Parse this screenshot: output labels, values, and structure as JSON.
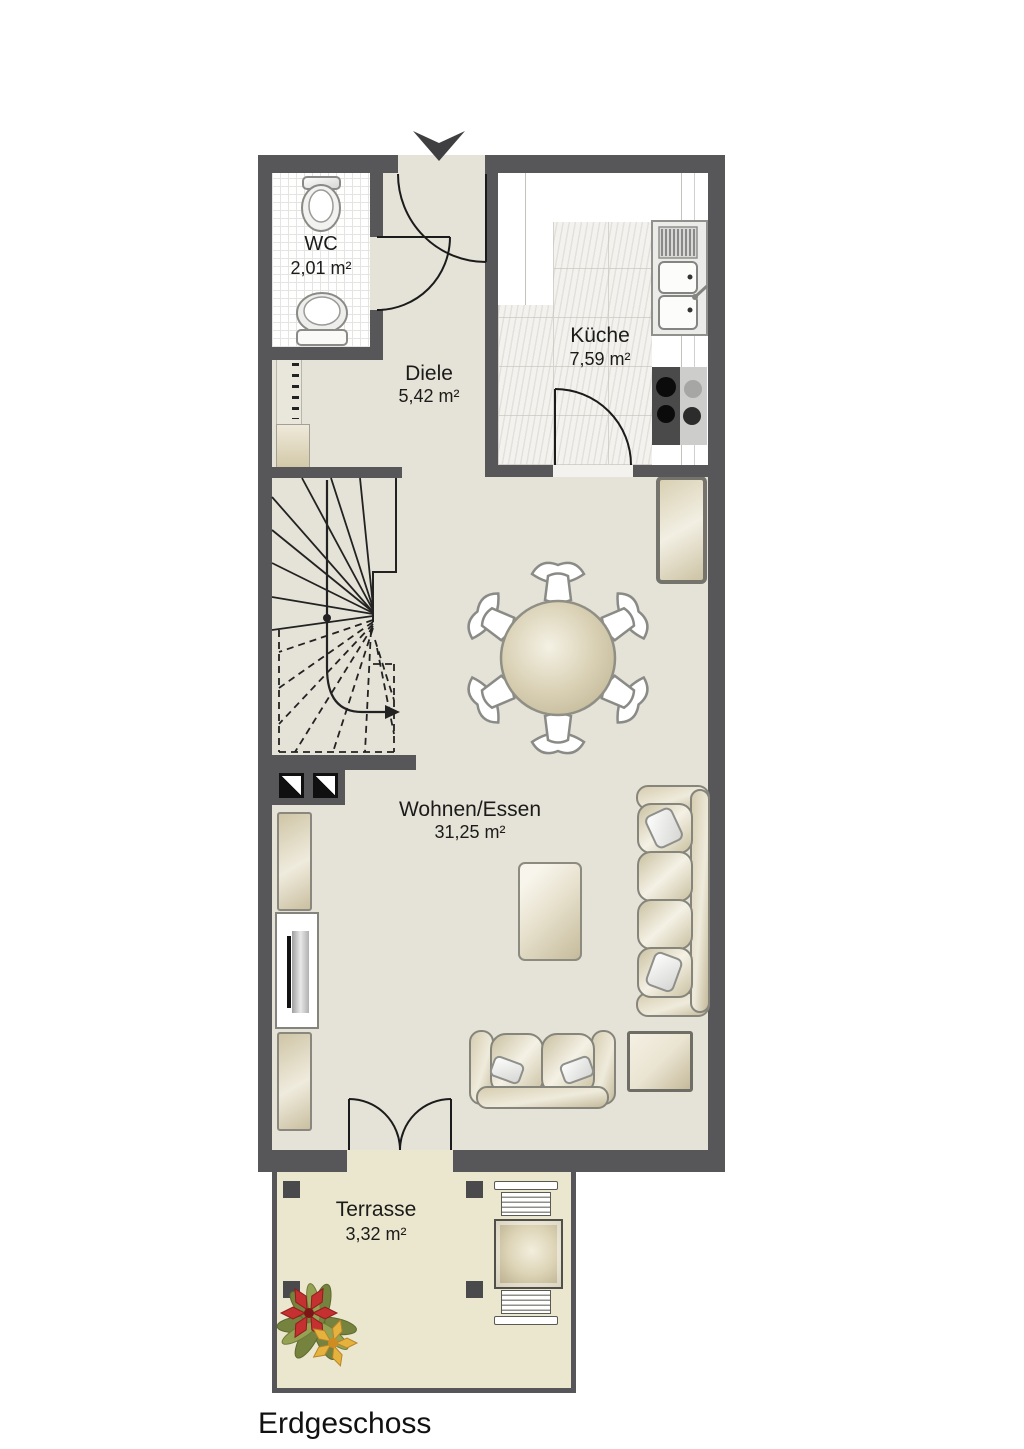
{
  "plan": {
    "floor_label": "Erdgeschoss",
    "rooms": [
      {
        "id": "wc",
        "name": "WC",
        "area": "2,01 m²"
      },
      {
        "id": "diele",
        "name": "Diele",
        "area": "5,42 m²"
      },
      {
        "id": "kueche",
        "name": "Küche",
        "area": "7,59 m²"
      },
      {
        "id": "wohnen-essen",
        "name": "Wohnen/Essen",
        "area": "31,25 m²"
      },
      {
        "id": "terrasse",
        "name": "Terrasse",
        "area": "3,32 m²"
      }
    ],
    "icons": {
      "entrance": "entrance-arrow-icon",
      "stairs": "winder-stairs-icon",
      "wc_fixtures": [
        "toilet-icon",
        "washbasin-icon"
      ],
      "kitchen_fixtures": [
        "kitchen-sink-icon",
        "cooktop-icon"
      ],
      "living_furniture": [
        "dining-table-icon",
        "chair-icon",
        "sofa-icon",
        "loveseat-icon",
        "coffee-table-icon",
        "side-table-icon",
        "tv-icon",
        "cabinet-icon"
      ],
      "terrace_items": [
        "garden-table-icon",
        "garden-bench-icon",
        "plant-icon",
        "post-icon"
      ],
      "shafts": "duct-shaft-icon",
      "radiator": "radiator-icon"
    },
    "colors": {
      "wall": "#57575a",
      "floor": "#e5e2d7",
      "kitchen_floor": "#f3f2ee",
      "wc_floor": "#ffffff",
      "terrace_floor": "#ebe7cf",
      "furniture": "#d5cbac",
      "line": "#1b1b1b",
      "background": "#ffffff"
    }
  }
}
